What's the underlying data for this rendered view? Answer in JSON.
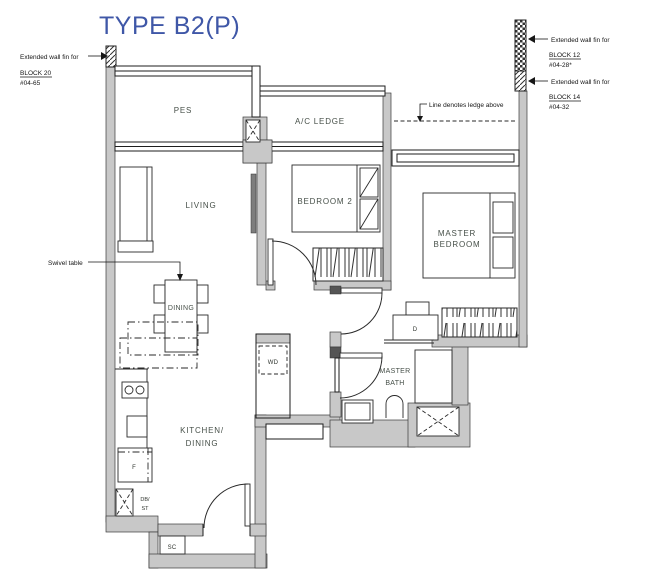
{
  "title": "TYPE B2(P)",
  "colors": {
    "title": "#3F57A7",
    "room_label": "#475049",
    "annotation": "#161616",
    "wall_fill": "#c8c8c8",
    "background": "#ffffff"
  },
  "rooms": {
    "pes": "PES",
    "ac_ledge": "A/C LEDGE",
    "living": "LIVING",
    "bedroom2": "BEDROOM 2",
    "master_line1": "MASTER",
    "master_line2": "BEDROOM",
    "dining": "DINING",
    "kitchen_line1": "KITCHEN/",
    "kitchen_line2": "DINING",
    "bath_line1": "MASTER",
    "bath_line2": "BATH"
  },
  "fixtures": {
    "wd": "WD",
    "dryer": "D",
    "fridge": "F",
    "db": "DB/",
    "st": "ST",
    "sc": "SC"
  },
  "annotations": {
    "swivel": "Swivel table",
    "ledge": "Line denotes ledge above",
    "fin_left": {
      "label": "Extended wall fin for",
      "block": "BLOCK 20",
      "unit": "#04-65"
    },
    "fin_right_top": {
      "label": "Extended wall fin for",
      "block": "BLOCK 12",
      "unit": "#04-28*"
    },
    "fin_right_bottom": {
      "label": "Extended wall fin for",
      "block": "BLOCK 14",
      "unit": "#04-32"
    }
  }
}
